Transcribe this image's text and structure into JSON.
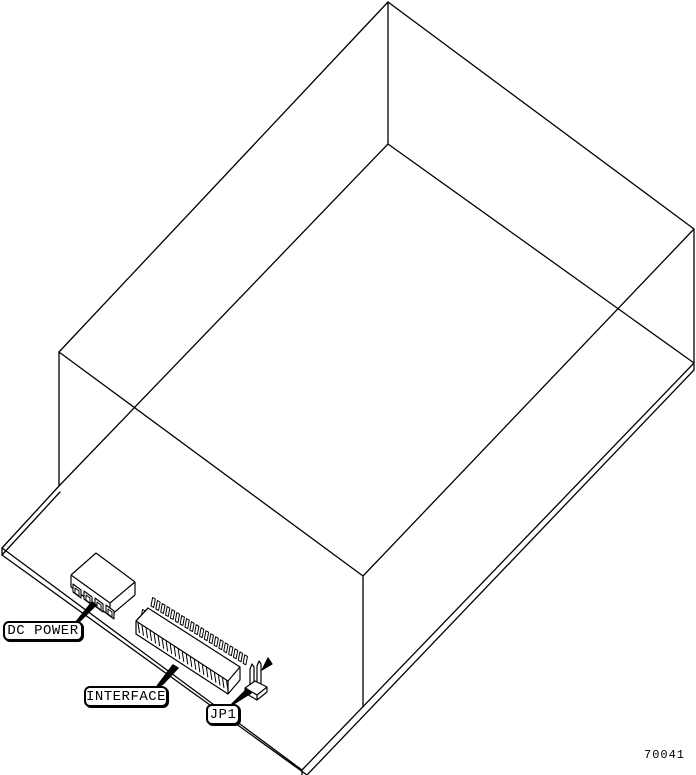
{
  "drawing": {
    "callouts": {
      "dc_power": "DC POWER",
      "interface": "INTERFACE",
      "jp1": "JP1"
    },
    "part_number": "70041",
    "colors": {
      "line": "#000000",
      "background": "#ffffff"
    }
  }
}
